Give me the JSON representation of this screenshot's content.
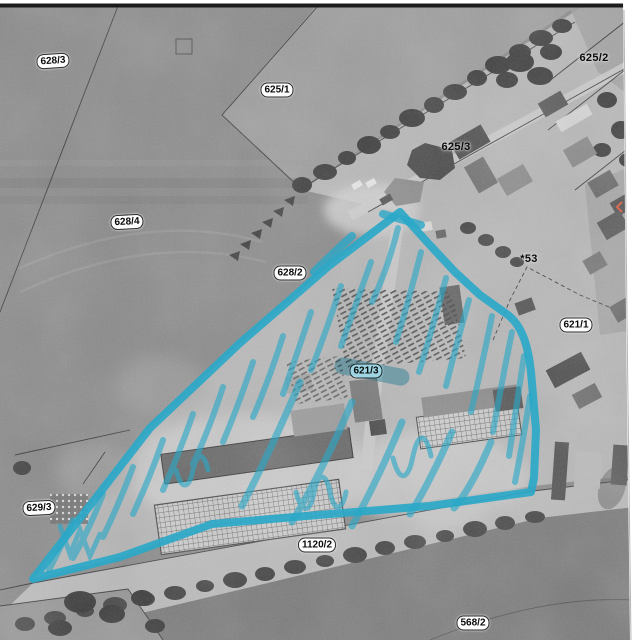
{
  "map": {
    "type": "cadastral-aerial-overlay",
    "highlight_color": "#2aa8c8",
    "photo_border_color": "#1c1c1c",
    "registration_mark_color": "#d96a55",
    "highlighted_parcel": {
      "label": "621/3",
      "marking": "cyan outline with diagonal hatching"
    },
    "labels": [
      {
        "id": "628-3",
        "text": "628/3",
        "x": 53,
        "y": 61,
        "style": "pill",
        "rot": -4
      },
      {
        "id": "625-1",
        "text": "625/1",
        "x": 277,
        "y": 90,
        "style": "pill",
        "rot": 0
      },
      {
        "id": "625-2",
        "text": "625/2",
        "x": 594,
        "y": 58,
        "style": "plain",
        "rot": 0
      },
      {
        "id": "625-3",
        "text": "625/3",
        "x": 456,
        "y": 147,
        "style": "plain",
        "rot": 0
      },
      {
        "id": "628-4",
        "text": "628/4",
        "x": 127,
        "y": 222,
        "style": "pill",
        "rot": -3
      },
      {
        "id": "628-2",
        "text": "628/2",
        "x": 290,
        "y": 273,
        "style": "pill",
        "rot": 0
      },
      {
        "id": "53",
        "text": "*53",
        "x": 529,
        "y": 259,
        "style": "plain",
        "rot": 0
      },
      {
        "id": "621-1",
        "text": "621/1",
        "x": 576,
        "y": 325,
        "style": "pill",
        "rot": 0
      },
      {
        "id": "621-3",
        "text": "621/3",
        "x": 366,
        "y": 371,
        "style": "pill",
        "rot": 0
      },
      {
        "id": "629-3",
        "text": "629/3",
        "x": 39,
        "y": 508,
        "style": "pill",
        "rot": -3
      },
      {
        "id": "1120-2",
        "text": "1120/2",
        "x": 317,
        "y": 545,
        "style": "pill",
        "rot": 0
      },
      {
        "id": "568-2",
        "text": "568/2",
        "x": 473,
        "y": 623,
        "style": "pill",
        "rot": 0
      }
    ]
  }
}
